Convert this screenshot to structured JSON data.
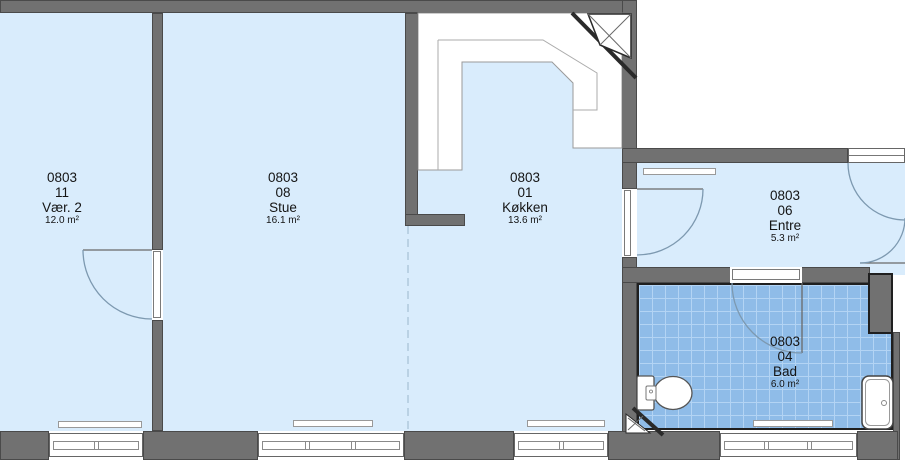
{
  "rooms": [
    {
      "building_no": "0803",
      "room_no": "11",
      "name": "Vær. 2",
      "area": "12.0 m²"
    },
    {
      "building_no": "0803",
      "room_no": "08",
      "name": "Stue",
      "area": "16.1 m²"
    },
    {
      "building_no": "0803",
      "room_no": "01",
      "name": "Køkken",
      "area": "13.6 m²"
    },
    {
      "building_no": "0803",
      "room_no": "06",
      "name": "Entre",
      "area": "5.3 m²"
    },
    {
      "building_no": "0803",
      "room_no": "04",
      "name": "Bad",
      "area": "6.0 m²"
    }
  ],
  "colors": {
    "floor": "#d9ecfc",
    "wall": "#717171",
    "bath_tile": "#8fbce8",
    "bath_tile_grid": "#b3d4f4",
    "door_arc": "#7d99b0"
  },
  "icons": [
    "toilet-icon",
    "bathtub-icon",
    "kitchen-counter",
    "shaft-hatch-icon",
    "window-icon",
    "door-swing-icon"
  ]
}
